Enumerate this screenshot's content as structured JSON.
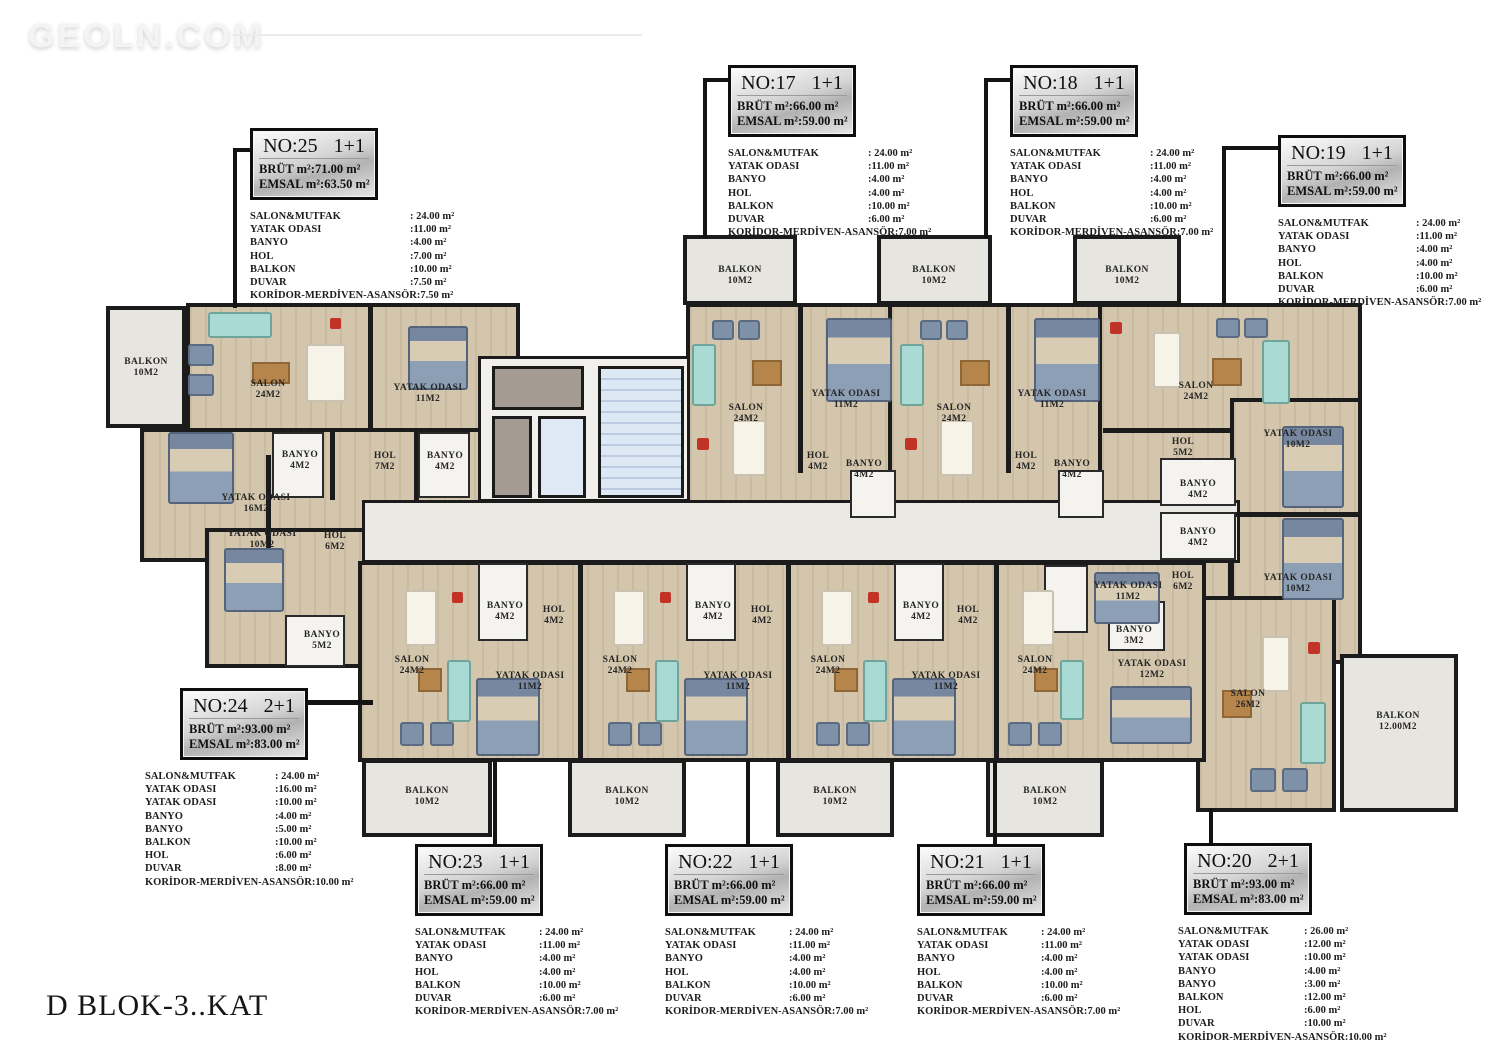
{
  "watermark": "GEOLN.COM",
  "floor_title": "D BLOK-3..KAT",
  "colors": {
    "wall": "#1b1b1b",
    "floor": "#d3c6ac",
    "balcony": "#e7e5df",
    "corridor": "#eae9e4",
    "stairs": "#dde8f5",
    "bed": "#8d9fb5",
    "sofa": "#a9dad3"
  },
  "info_panels": [
    {
      "no": "NO:25",
      "type": "1+1",
      "brut": "BRÜT m²:71.00 m²",
      "emsal": "EMSAL m²:63.50 m²",
      "rooms": [
        {
          "label": "SALON&MUTFAK",
          "value": ": 24.00 m²"
        },
        {
          "label": "YATAK ODASI",
          "value": ":11.00 m²"
        },
        {
          "label": "BANYO",
          "value": ":4.00 m²"
        },
        {
          "label": "HOL",
          "value": ":7.00 m²"
        },
        {
          "label": "BALKON",
          "value": ":10.00 m²"
        },
        {
          "label": "DUVAR",
          "value": ":7.50 m²"
        },
        {
          "label": "KORİDOR-MERDİVEN-ASANSÖR",
          "value": ":7.50 m²"
        }
      ]
    },
    {
      "no": "NO:17",
      "type": "1+1",
      "brut": "BRÜT m²:66.00 m²",
      "emsal": "EMSAL m²:59.00 m²",
      "rooms": [
        {
          "label": "SALON&MUTFAK",
          "value": ": 24.00 m²"
        },
        {
          "label": "YATAK ODASI",
          "value": ":11.00 m²"
        },
        {
          "label": "BANYO",
          "value": ":4.00 m²"
        },
        {
          "label": "HOL",
          "value": ":4.00 m²"
        },
        {
          "label": "BALKON",
          "value": ":10.00 m²"
        },
        {
          "label": "DUVAR",
          "value": ":6.00 m²"
        },
        {
          "label": "KORİDOR-MERDİVEN-ASANSÖR",
          "value": ":7.00 m²"
        }
      ]
    },
    {
      "no": "NO:18",
      "type": "1+1",
      "brut": "BRÜT m²:66.00 m²",
      "emsal": "EMSAL m²:59.00 m²",
      "rooms": [
        {
          "label": "SALON&MUTFAK",
          "value": ": 24.00 m²"
        },
        {
          "label": "YATAK ODASI",
          "value": ":11.00 m²"
        },
        {
          "label": "BANYO",
          "value": ":4.00 m²"
        },
        {
          "label": "HOL",
          "value": ":4.00 m²"
        },
        {
          "label": "BALKON",
          "value": ":10.00 m²"
        },
        {
          "label": "DUVAR",
          "value": ":6.00 m²"
        },
        {
          "label": "KORİDOR-MERDİVEN-ASANSÖR",
          "value": ":7.00 m²"
        }
      ]
    },
    {
      "no": "NO:19",
      "type": "1+1",
      "brut": "BRÜT m²:66.00 m²",
      "emsal": "EMSAL m²:59.00 m²",
      "rooms": [
        {
          "label": "SALON&MUTFAK",
          "value": ": 24.00 m²"
        },
        {
          "label": "YATAK ODASI",
          "value": ":11.00 m²"
        },
        {
          "label": "BANYO",
          "value": ":4.00 m²"
        },
        {
          "label": "HOL",
          "value": ":4.00 m²"
        },
        {
          "label": "BALKON",
          "value": ":10.00 m²"
        },
        {
          "label": "DUVAR",
          "value": ":6.00 m²"
        },
        {
          "label": "KORİDOR-MERDİVEN-ASANSÖR",
          "value": ":7.00 m²"
        }
      ]
    },
    {
      "no": "NO:24",
      "type": "2+1",
      "brut": "BRÜT m²:93.00 m²",
      "emsal": "EMSAL m²:83.00 m²",
      "rooms": [
        {
          "label": "SALON&MUTFAK",
          "value": ": 24.00 m²"
        },
        {
          "label": "YATAK ODASI",
          "value": ":16.00 m²"
        },
        {
          "label": "YATAK ODASI",
          "value": ":10.00 m²"
        },
        {
          "label": "BANYO",
          "value": ":4.00 m²"
        },
        {
          "label": "BANYO",
          "value": ":5.00 m²"
        },
        {
          "label": "BALKON",
          "value": ":10.00 m²"
        },
        {
          "label": "HOL",
          "value": ":6.00 m²"
        },
        {
          "label": "DUVAR",
          "value": ":8.00 m²"
        },
        {
          "label": "KORİDOR-MERDİVEN-ASANSÖR",
          "value": ":10.00 m²"
        }
      ]
    },
    {
      "no": "NO:23",
      "type": "1+1",
      "brut": "BRÜT m²:66.00 m²",
      "emsal": "EMSAL m²:59.00 m²",
      "rooms": [
        {
          "label": "SALON&MUTFAK",
          "value": ": 24.00 m²"
        },
        {
          "label": "YATAK ODASI",
          "value": ":11.00 m²"
        },
        {
          "label": "BANYO",
          "value": ":4.00 m²"
        },
        {
          "label": "HOL",
          "value": ":4.00 m²"
        },
        {
          "label": "BALKON",
          "value": ":10.00 m²"
        },
        {
          "label": "DUVAR",
          "value": ":6.00 m²"
        },
        {
          "label": "KORİDOR-MERDİVEN-ASANSÖR",
          "value": ":7.00 m²"
        }
      ]
    },
    {
      "no": "NO:22",
      "type": "1+1",
      "brut": "BRÜT m²:66.00 m²",
      "emsal": "EMSAL m²:59.00 m²",
      "rooms": [
        {
          "label": "SALON&MUTFAK",
          "value": ": 24.00 m²"
        },
        {
          "label": "YATAK ODASI",
          "value": ":11.00 m²"
        },
        {
          "label": "BANYO",
          "value": ":4.00 m²"
        },
        {
          "label": "HOL",
          "value": ":4.00 m²"
        },
        {
          "label": "BALKON",
          "value": ":10.00 m²"
        },
        {
          "label": "DUVAR",
          "value": ":6.00 m²"
        },
        {
          "label": "KORİDOR-MERDİVEN-ASANSÖR",
          "value": ":7.00 m²"
        }
      ]
    },
    {
      "no": "NO:21",
      "type": "1+1",
      "brut": "BRÜT m²:66.00 m²",
      "emsal": "EMSAL m²:59.00 m²",
      "rooms": [
        {
          "label": "SALON&MUTFAK",
          "value": ": 24.00 m²"
        },
        {
          "label": "YATAK ODASI",
          "value": ":11.00 m²"
        },
        {
          "label": "BANYO",
          "value": ":4.00 m²"
        },
        {
          "label": "HOL",
          "value": ":4.00 m²"
        },
        {
          "label": "BALKON",
          "value": ":10.00 m²"
        },
        {
          "label": "DUVAR",
          "value": ":6.00 m²"
        },
        {
          "label": "KORİDOR-MERDİVEN-ASANSÖR",
          "value": ":7.00 m²"
        }
      ]
    },
    {
      "no": "NO:20",
      "type": "2+1",
      "brut": "BRÜT m²:93.00 m²",
      "emsal": "EMSAL m²:83.00 m²",
      "rooms": [
        {
          "label": "SALON&MUTFAK",
          "value": ": 26.00 m²"
        },
        {
          "label": "YATAK ODASI",
          "value": ":12.00 m²"
        },
        {
          "label": "YATAK ODASI",
          "value": ":10.00 m²"
        },
        {
          "label": "BANYO",
          "value": ":4.00 m²"
        },
        {
          "label": "BANYO",
          "value": ":3.00 m²"
        },
        {
          "label": "BALKON",
          "value": ":12.00 m²"
        },
        {
          "label": "HOL",
          "value": ":6.00 m²"
        },
        {
          "label": "DUVAR",
          "value": ":10.00 m²"
        },
        {
          "label": "KORİDOR-MERDİVEN-ASANSÖR",
          "value": ":10.00 m²"
        }
      ]
    }
  ],
  "plan_labels": [
    {
      "text": "BALKON\n10M2",
      "x": 146,
      "y": 368
    },
    {
      "text": "SALON\n24M2",
      "x": 268,
      "y": 390
    },
    {
      "text": "YATAK ODASI\n11M2",
      "x": 428,
      "y": 394
    },
    {
      "text": "BANYO\n4M2",
      "x": 300,
      "y": 461
    },
    {
      "text": "HOL\n7M2",
      "x": 385,
      "y": 462
    },
    {
      "text": "BANYO\n4M2",
      "x": 445,
      "y": 462
    },
    {
      "text": "YATAK ODASI\n16M2",
      "x": 256,
      "y": 504
    },
    {
      "text": "HOL\n6M2",
      "x": 335,
      "y": 542
    },
    {
      "text": "YATAK ODASI\n10M2",
      "x": 262,
      "y": 540
    },
    {
      "text": "BANYO\n5M2",
      "x": 322,
      "y": 641
    },
    {
      "text": "BALKON\n10M2",
      "x": 740,
      "y": 276
    },
    {
      "text": "BALKON\n10M2",
      "x": 934,
      "y": 276
    },
    {
      "text": "BALKON\n10M2",
      "x": 1127,
      "y": 276
    },
    {
      "text": "SALON\n24M2",
      "x": 746,
      "y": 414
    },
    {
      "text": "YATAK ODASI\n11M2",
      "x": 846,
      "y": 400
    },
    {
      "text": "HOL\n4M2",
      "x": 818,
      "y": 462
    },
    {
      "text": "BANYO\n4M2",
      "x": 864,
      "y": 470
    },
    {
      "text": "SALON\n24M2",
      "x": 954,
      "y": 414
    },
    {
      "text": "YATAK ODASI\n11M2",
      "x": 1052,
      "y": 400
    },
    {
      "text": "HOL\n4M2",
      "x": 1026,
      "y": 462
    },
    {
      "text": "BANYO\n4M2",
      "x": 1072,
      "y": 470
    },
    {
      "text": "SALON\n24M2",
      "x": 1196,
      "y": 392
    },
    {
      "text": "HOL\n5M2",
      "x": 1183,
      "y": 448
    },
    {
      "text": "BANYO\n4M2",
      "x": 1198,
      "y": 490
    },
    {
      "text": "YATAK ODASI\n10M2",
      "x": 1298,
      "y": 440
    },
    {
      "text": "BANYO\n4M2",
      "x": 1198,
      "y": 538
    },
    {
      "text": "HOL\n6M2",
      "x": 1183,
      "y": 582
    },
    {
      "text": "YATAK ODASI\n10M2",
      "x": 1298,
      "y": 584
    },
    {
      "text": "BANYO\n3M2",
      "x": 1134,
      "y": 636
    },
    {
      "text": "YATAK ODASI\n12M2",
      "x": 1152,
      "y": 670
    },
    {
      "text": "SALON\n26M2",
      "x": 1248,
      "y": 700
    },
    {
      "text": "BALKON\n12.00M2",
      "x": 1398,
      "y": 722
    },
    {
      "text": "SALON\n24M2",
      "x": 412,
      "y": 666
    },
    {
      "text": "BANYO\n4M2",
      "x": 505,
      "y": 612
    },
    {
      "text": "HOL\n4M2",
      "x": 554,
      "y": 616
    },
    {
      "text": "YATAK ODASI\n11M2",
      "x": 530,
      "y": 682
    },
    {
      "text": "SALON\n24M2",
      "x": 620,
      "y": 666
    },
    {
      "text": "BANYO\n4M2",
      "x": 713,
      "y": 612
    },
    {
      "text": "HOL\n4M2",
      "x": 762,
      "y": 616
    },
    {
      "text": "YATAK ODASI\n11M2",
      "x": 738,
      "y": 682
    },
    {
      "text": "SALON\n24M2",
      "x": 828,
      "y": 666
    },
    {
      "text": "BANYO\n4M2",
      "x": 921,
      "y": 612
    },
    {
      "text": "HOL\n4M2",
      "x": 968,
      "y": 616
    },
    {
      "text": "YATAK ODASI\n11M2",
      "x": 946,
      "y": 682
    },
    {
      "text": "SALON\n24M2",
      "x": 1035,
      "y": 666
    },
    {
      "text": "YATAK ODASI\n11M2",
      "x": 1128,
      "y": 592
    },
    {
      "text": "BALKON\n10M2",
      "x": 427,
      "y": 797
    },
    {
      "text": "BALKON\n10M2",
      "x": 627,
      "y": 797
    },
    {
      "text": "BALKON\n10M2",
      "x": 835,
      "y": 797
    },
    {
      "text": "BALKON\n10M2",
      "x": 1045,
      "y": 797
    }
  ]
}
